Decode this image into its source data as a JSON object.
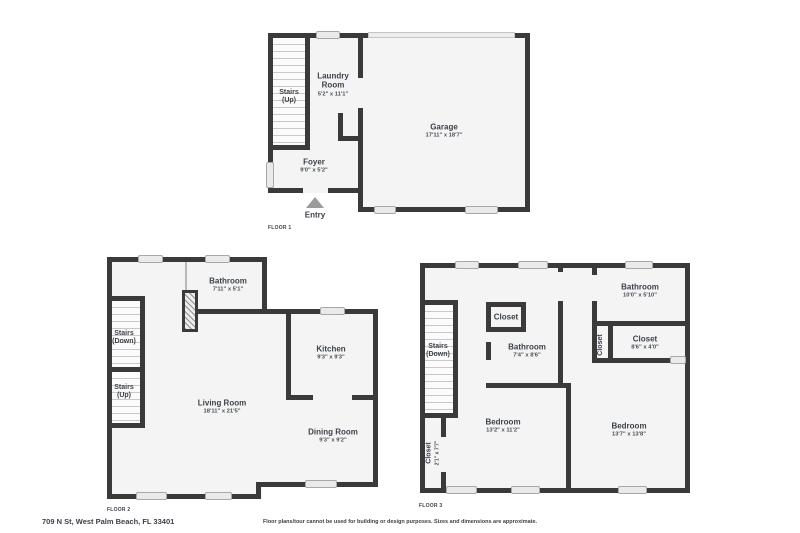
{
  "colors": {
    "wall": "#3a3a3a",
    "floor": "#f4f4f4",
    "window": "#eaeaea",
    "text": "#3c424a"
  },
  "floor1": {
    "label": "FLOOR 1",
    "stairs": {
      "name": "Stairs",
      "dir": "(Up)"
    },
    "laundry": {
      "name": "Laundry Room",
      "dims": "5'2\" x 11'1\""
    },
    "garage": {
      "name": "Garage",
      "dims": "17'11\" x 18'7\""
    },
    "foyer": {
      "name": "Foyer",
      "dims": "9'0\" x 5'2\""
    },
    "entry": "Entry"
  },
  "floor2": {
    "label": "FLOOR 2",
    "bathroom": {
      "name": "Bathroom",
      "dims": "7'11\" x 5'1\""
    },
    "stairs_down": {
      "name": "Stairs",
      "dir": "(Down)"
    },
    "stairs_up": {
      "name": "Stairs",
      "dir": "(Up)"
    },
    "kitchen": {
      "name": "Kitchen",
      "dims": "9'3\" x 9'3\""
    },
    "living_room": {
      "name": "Living Room",
      "dims": "18'11\" x 21'5\""
    },
    "dining_room": {
      "name": "Dining Room",
      "dims": "9'3\" x 9'2\""
    }
  },
  "floor3": {
    "label": "FLOOR 3",
    "stairs_down": {
      "name": "Stairs",
      "dir": "(Down)"
    },
    "closet_hall": {
      "name": "Closet"
    },
    "bathroom_mid": {
      "name": "Bathroom",
      "dims": "7'4\" x 8'6\""
    },
    "bathroom_top": {
      "name": "Bathroom",
      "dims": "10'0\" x 5'10\""
    },
    "closet_mid": {
      "name": "Closet"
    },
    "closet_right": {
      "name": "Closet",
      "dims": "8'6\" x 4'0\""
    },
    "bedroom_left": {
      "name": "Bedroom",
      "dims": "13'2\" x 11'2\""
    },
    "bedroom_right": {
      "name": "Bedroom",
      "dims": "13'7\" x 13'8\""
    },
    "closet_bottom_left": {
      "name": "Closet",
      "dims": "2'1\" x 7'7\""
    }
  },
  "footer": {
    "address": "709 N St, West Palm Beach, FL 33401",
    "disclaimer": "Floor plans/tour cannot be used for building or design purposes. Sizes and dimensions are approximate."
  }
}
